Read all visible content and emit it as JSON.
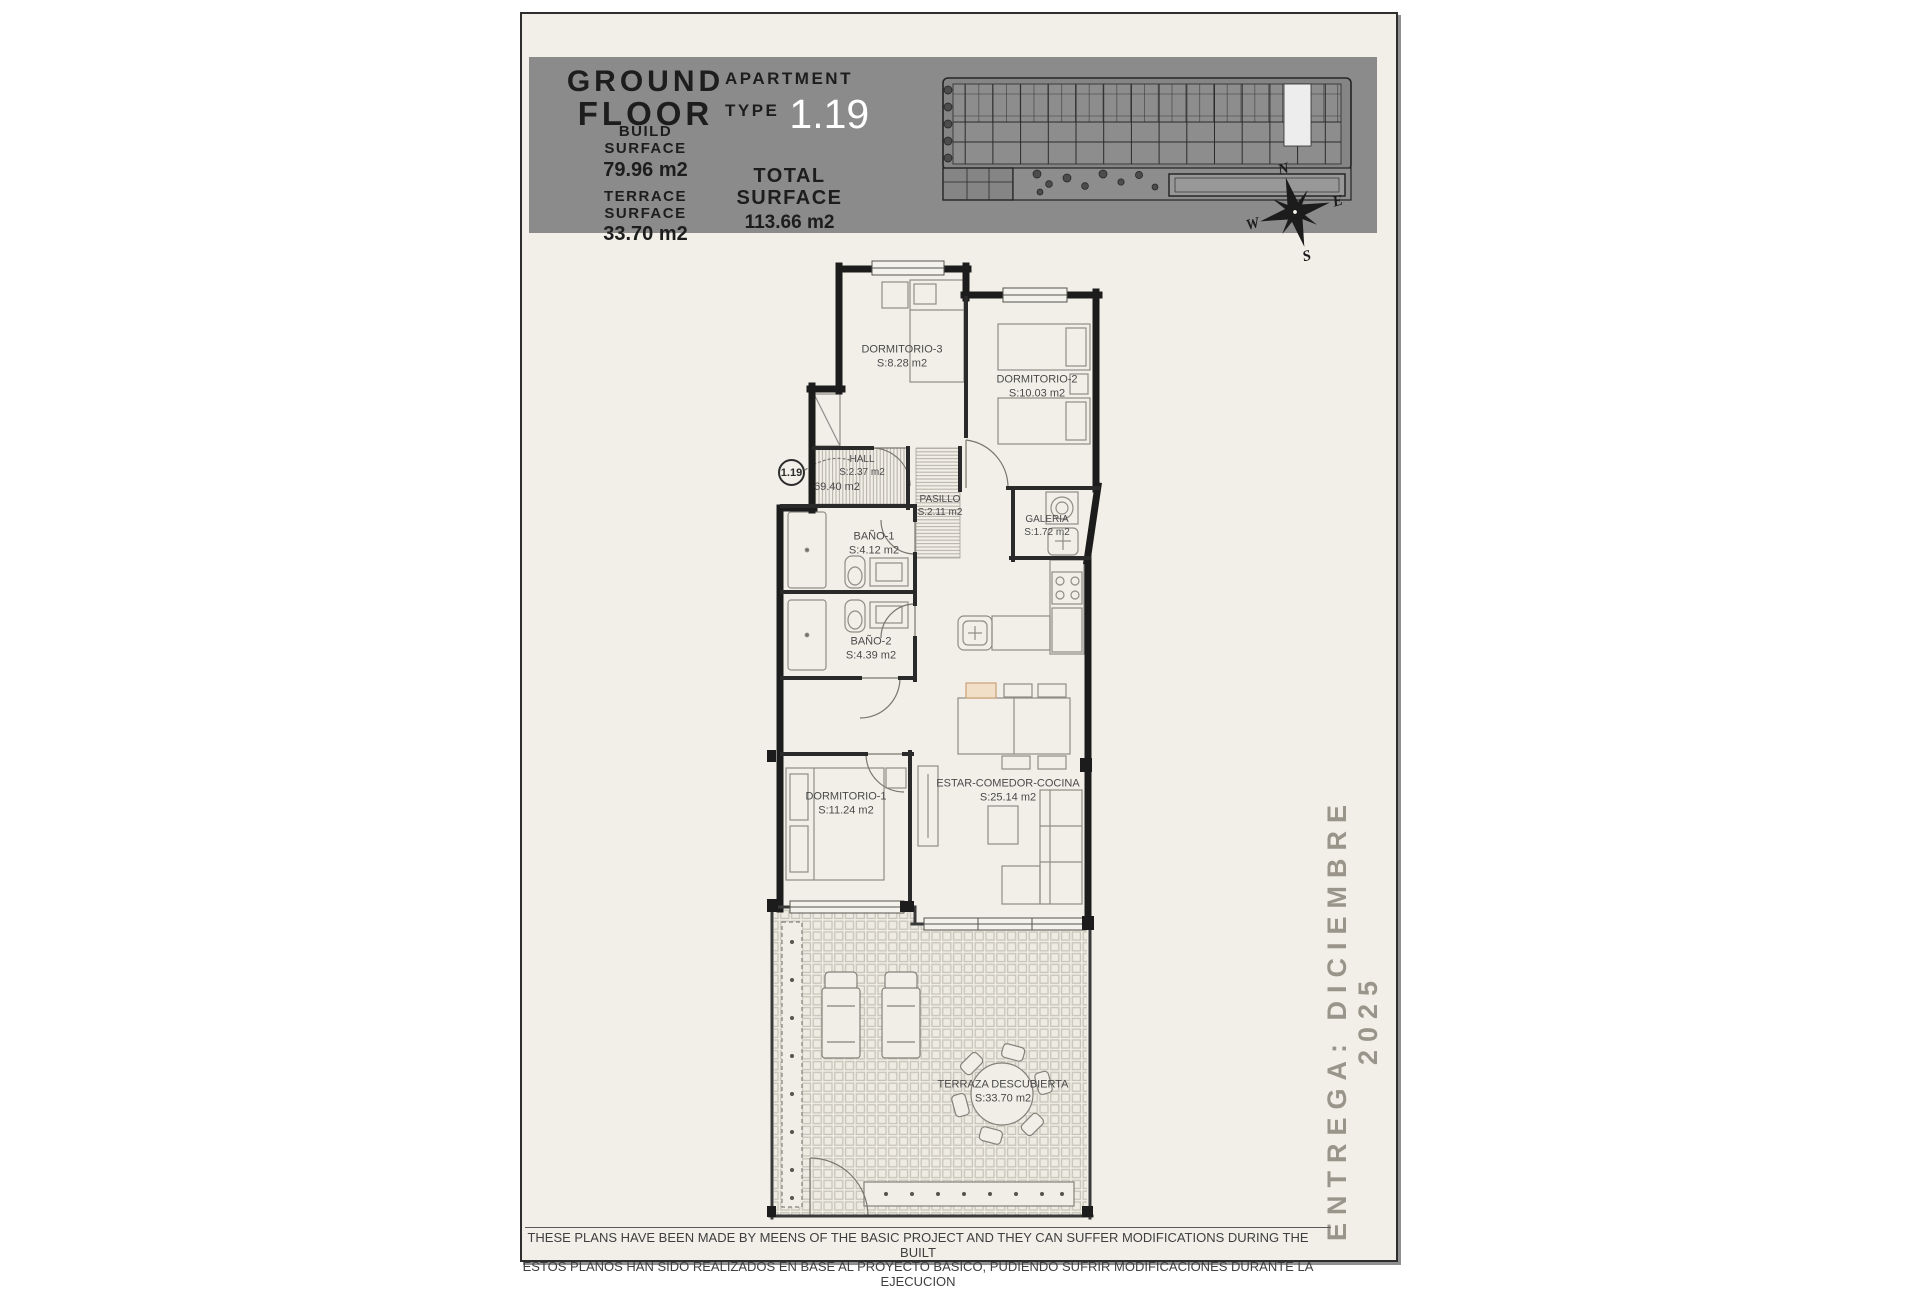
{
  "header": {
    "floor_line1": "GROUND",
    "floor_line2": "FLOOR",
    "build_surface_label": "BUILD SURFACE",
    "build_surface_value": "79.96 m2",
    "terrace_surface_label": "TERRACE SURFACE",
    "terrace_surface_value": "33.70 m2",
    "apartment_label": "APARTMENT",
    "type_label": "TYPE",
    "apartment_number": "1.19",
    "total_surface_label": "TOTAL SURFACE",
    "total_surface_value": "113.66 m2"
  },
  "compass": {
    "north": "N",
    "east": "E",
    "south": "S",
    "west": "W"
  },
  "plan": {
    "unit_marker": "1.19",
    "common_area_note": "69.40 m2",
    "rooms": [
      {
        "id": "dormitorio-3",
        "name": "DORMITORIO-3",
        "area": "S:8.28 m2"
      },
      {
        "id": "dormitorio-2",
        "name": "DORMITORIO-2",
        "area": "S:10.03 m2"
      },
      {
        "id": "hall",
        "name": "HALL",
        "area": "S:2.37 m2"
      },
      {
        "id": "pasillo",
        "name": "PASILLO",
        "area": "S:2.11 m2"
      },
      {
        "id": "galeria",
        "name": "GALERIA",
        "area": "S:1.72 m2"
      },
      {
        "id": "bano-1",
        "name": "BAÑO-1",
        "area": "S:4.12 m2"
      },
      {
        "id": "bano-2",
        "name": "BAÑO-2",
        "area": "S:4.39 m2"
      },
      {
        "id": "dormitorio-1",
        "name": "DORMITORIO-1",
        "area": "S:11.24 m2"
      },
      {
        "id": "estar-comedor-cocina",
        "name": "ESTAR-COMEDOR-COCINA",
        "area": "S:25.14 m2"
      },
      {
        "id": "terraza-descubierta",
        "name": "TERRAZA DESCUBIERTA",
        "area": "S:33.70 m2"
      }
    ]
  },
  "side_note": "ENTREGA: DICIEMBRE 2025",
  "footer": {
    "line1": "THESE PLANS HAVE BEEN MADE BY MEENS OF THE BASIC PROJECT AND THEY CAN SUFFER MODIFICATIONS DURING THE BUILT",
    "line2": "ESTOS PLANOS HAN SIDO REALIZADOS EN BASE AL PROYECTO BASICO, PUDIENDO SUFRIR MODIFICACIONES DURANTE LA EJECUCION"
  },
  "colors": {
    "paper": "#f1efe8",
    "header_bg": "#8b8b8b",
    "apartment_number": "#ffffff",
    "accent_chair": "#f2dfc8",
    "wall": "#1c1c1c"
  }
}
